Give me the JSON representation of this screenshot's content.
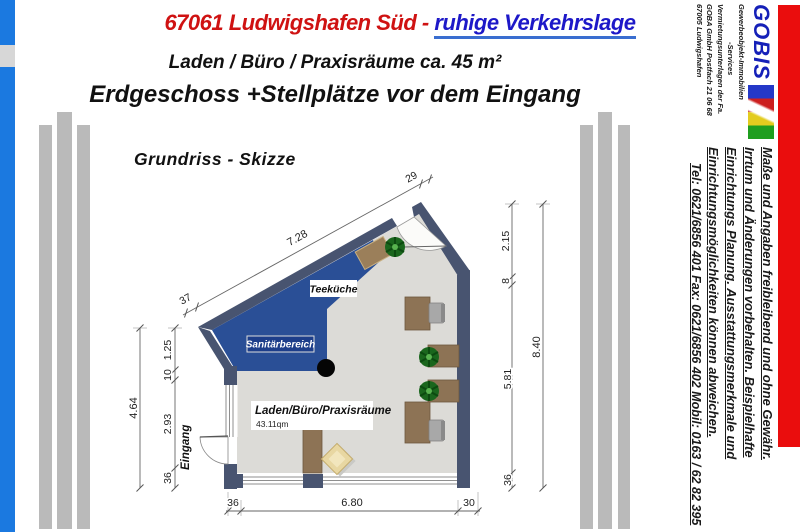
{
  "header": {
    "title_red": "67061 Ludwigshafen Süd - ",
    "title_blue": "ruhige Verkehrslage",
    "subtitle_line1": "Laden / Büro / Praxisräume ca. 45 m²",
    "subtitle_line2": "Erdgeschoss +Stellplätze vor dem Eingang"
  },
  "branding": {
    "logo_text": "GOBIS",
    "lines": [
      "Gewerbeobjekt-Immobilien",
      "-Services",
      "Vermietungsunterlagen der Fa.",
      "GOBA GmbH Postfach 21 06 68",
      "67005 Ludwigshafen"
    ],
    "logo_colors": [
      "#2438c8",
      "#cc1f1f",
      "#e3cc1f",
      "#1f9e1f"
    ]
  },
  "sidebar_notes": {
    "lines": [
      "Maße und Angaben freibleibend und ohne Gewähr.",
      "Irrtum und Änderungen vorbehalten. Beispielhafte",
      "Einrichtungs Planung. Ausstattungsmerkmale und",
      "Einrichtungsmöglichkeiten können abweichen."
    ],
    "contact": "Tel: 0621/6856 401    Fax: 0621/6856 402    Mobil: 0163 / 62 82 395"
  },
  "plan": {
    "title": "Grundriss - Skizze",
    "labels": {
      "teekueche": "Teeküche",
      "sanitaer": "Sanitärbereich",
      "main_room": "Laden/Büro/Praxisräume",
      "main_area": "43.11qm",
      "entrance": "Eingang"
    },
    "dims": {
      "top_left": "37",
      "top": "7.28",
      "top_right": "29",
      "right_1": "2.15",
      "right_2": "8",
      "right_3": "5.81",
      "right_4": "36",
      "right_total": "8.40",
      "left_1": "1.25",
      "left_2": "10",
      "left_3": "2.93",
      "left_4": "36",
      "left_total": "4.64",
      "bottom_1": "36",
      "bottom_2": "6.80",
      "bottom_3": "30"
    }
  },
  "colors": {
    "edge_bar_blue": "#1b79e0",
    "edge_bar_red": "#ea0d0d",
    "wall": "#485470",
    "wet_zone_blue": "#2a4f96",
    "floor": "#dcdbd7",
    "headline_red": "#cf1212",
    "headline_blue": "#1d18c8"
  }
}
